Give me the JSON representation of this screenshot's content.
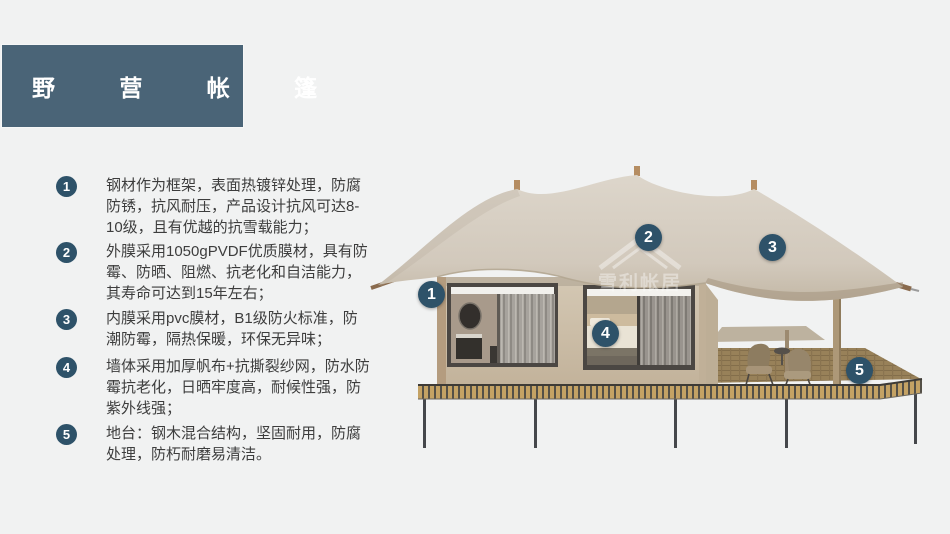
{
  "title": {
    "label": "野 营 帐 篷"
  },
  "features": [
    {
      "num": "1",
      "text": "钢材作为框架，表面热镀锌处理，防腐防锈，抗风耐压，产品设计抗风可达8-10级，且有优越的抗雪载能力；"
    },
    {
      "num": "2",
      "text": "外膜采用1050gPVDF优质膜材，具有防霉、防晒、阻燃、抗老化和自洁能力，其寿命可达到15年左右；"
    },
    {
      "num": "3",
      "text": "内膜采用pvc膜材，B1级防火标准，防潮防霉，隔热保暖，环保无异味；"
    },
    {
      "num": "4",
      "text": "墙体采用加厚帆布+抗撕裂纱网，防水防霉抗老化，日晒牢度高，耐候性强，防紫外线强；"
    },
    {
      "num": "5",
      "text": "地台：钢木混合结构，坚固耐用，防腐处理，防朽耐磨易清洁。"
    }
  ],
  "callouts": [
    {
      "num": "1"
    },
    {
      "num": "2"
    },
    {
      "num": "3"
    },
    {
      "num": "4"
    },
    {
      "num": "5"
    }
  ],
  "watermark": {
    "text": "雪利帐居"
  },
  "colors": {
    "accent_badge": "#2e5269",
    "title_bg": "#4a6477",
    "background": "#f1f2f2",
    "canopy": "#d5ccc0",
    "cabin_wall": "#cdc0ab",
    "deck_slat": "#c4a264",
    "text": "#3d3d3d"
  }
}
